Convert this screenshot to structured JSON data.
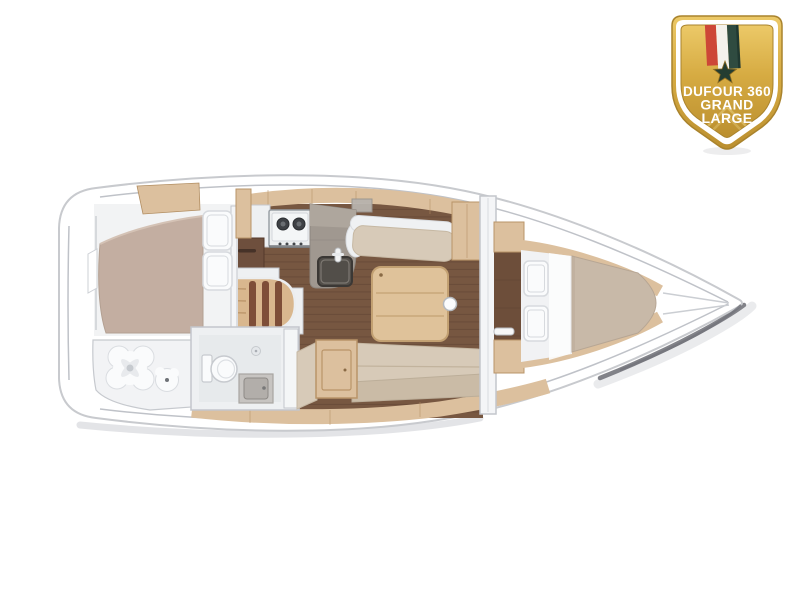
{
  "badge": {
    "line1": "DUFOUR 360",
    "line2": "GRAND",
    "line3": "LARGE",
    "colors": {
      "gold_light": "#ecc968",
      "gold": "#d6ab42",
      "gold_dark": "#bb8f2f",
      "rim": "#a9832d",
      "band_white": "#ffffff",
      "ribbon_red": "#cd4737",
      "ribbon_white": "#f4f2ec",
      "ribbon_green": "#2f4b40",
      "ribbon_green_dark": "#203830",
      "star": "#243d31",
      "text": "#ffffff",
      "watermark": "#e9cd7c"
    }
  },
  "floorplan": {
    "colors": {
      "hull": "#ffffff",
      "hull_stroke": "#c8cace",
      "toe_rail": "#bfc2c8",
      "shadow_soft": "#dcdde1",
      "shadow_dark": "#74757c",
      "wood": "#dcc09e",
      "wood_seam": "#b28e62",
      "floor": "#775741",
      "floor_line": "#5f4434",
      "passage_floor": "#6d4e3a",
      "wall": "#eef0f2",
      "wall_stroke": "#c3c6cc",
      "room_floor": "#e7eaec",
      "mattress": "#c3aea1",
      "mattress_fwd": "#c8b9a8",
      "sheet": "#f1f2f4",
      "pillow": "#fafbfc",
      "pillow_stroke": "#d7dade",
      "cushion": "#d7cab8",
      "cushion_dark": "#cabba6",
      "backrest": "#eff1f3",
      "counter": "#a09890",
      "counter_light": "#aea69d",
      "sink": "#524e49",
      "stove": "#edeff0",
      "burner": "#3e4145",
      "desk": "#6e4f3d",
      "stair_wood": "#d9b78e",
      "stair_stripe": "#7e4e38",
      "table": "#dfc29a",
      "table_stroke": "#c2a072",
      "fixture": "#fafbfc",
      "fixture_stroke": "#c7cacf",
      "cabinet_stroke": "#b99468"
    }
  }
}
